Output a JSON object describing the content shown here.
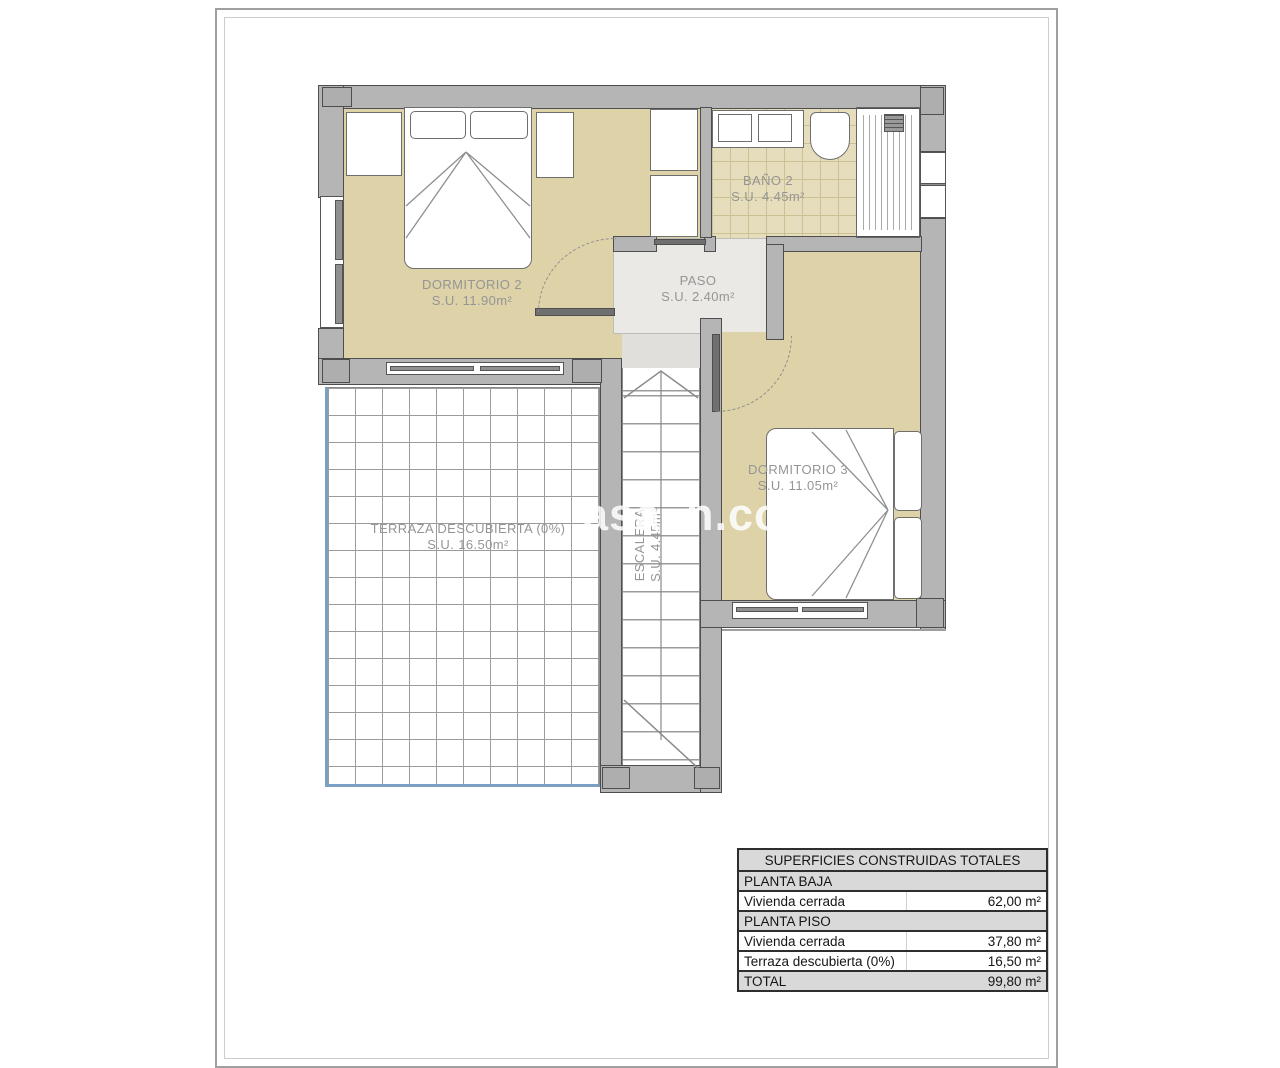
{
  "watermark": {
    "left_fragment": "asa",
    "right_fragment": "n.com"
  },
  "plan": {
    "rooms": [
      {
        "name": "DORMITORIO 2",
        "area": "S.U. 11.90m²"
      },
      {
        "name": "BAÑO 2",
        "area": "S.U. 4.45m²"
      },
      {
        "name": "PASO",
        "area": "S.U. 2.40m²"
      },
      {
        "name": "DORMITORIO 3",
        "area": "S.U. 11.05m²"
      },
      {
        "name": "TERRAZA DESCUBIERTA (0%)",
        "area": "S.U. 16.50m²"
      },
      {
        "name": "ESCALERA",
        "area": "S.U. 4.45m²"
      }
    ]
  },
  "summary_table": {
    "title": "SUPERFICIES CONSTRUIDAS TOTALES",
    "sections": [
      {
        "header": "PLANTA BAJA",
        "rows": [
          {
            "label": "Vivienda cerrada",
            "value": "62,00 m²"
          }
        ]
      },
      {
        "header": "PLANTA PISO",
        "rows": [
          {
            "label": "Vivienda cerrada",
            "value": "37,80 m²"
          },
          {
            "label": "Terraza descubierta (0%)",
            "value": "16,50 m²"
          }
        ]
      }
    ],
    "total": {
      "label": "TOTAL",
      "value": "99,80 m²"
    }
  },
  "colors": {
    "floor_beige": "#ddd2a8",
    "wall_gray": "#b5b5b5",
    "wall_outline": "#4e4e4e",
    "terrace_edge_blue": "#7aa0c4",
    "table_header_bg": "#d9d9d9",
    "label_text": "#959595"
  }
}
